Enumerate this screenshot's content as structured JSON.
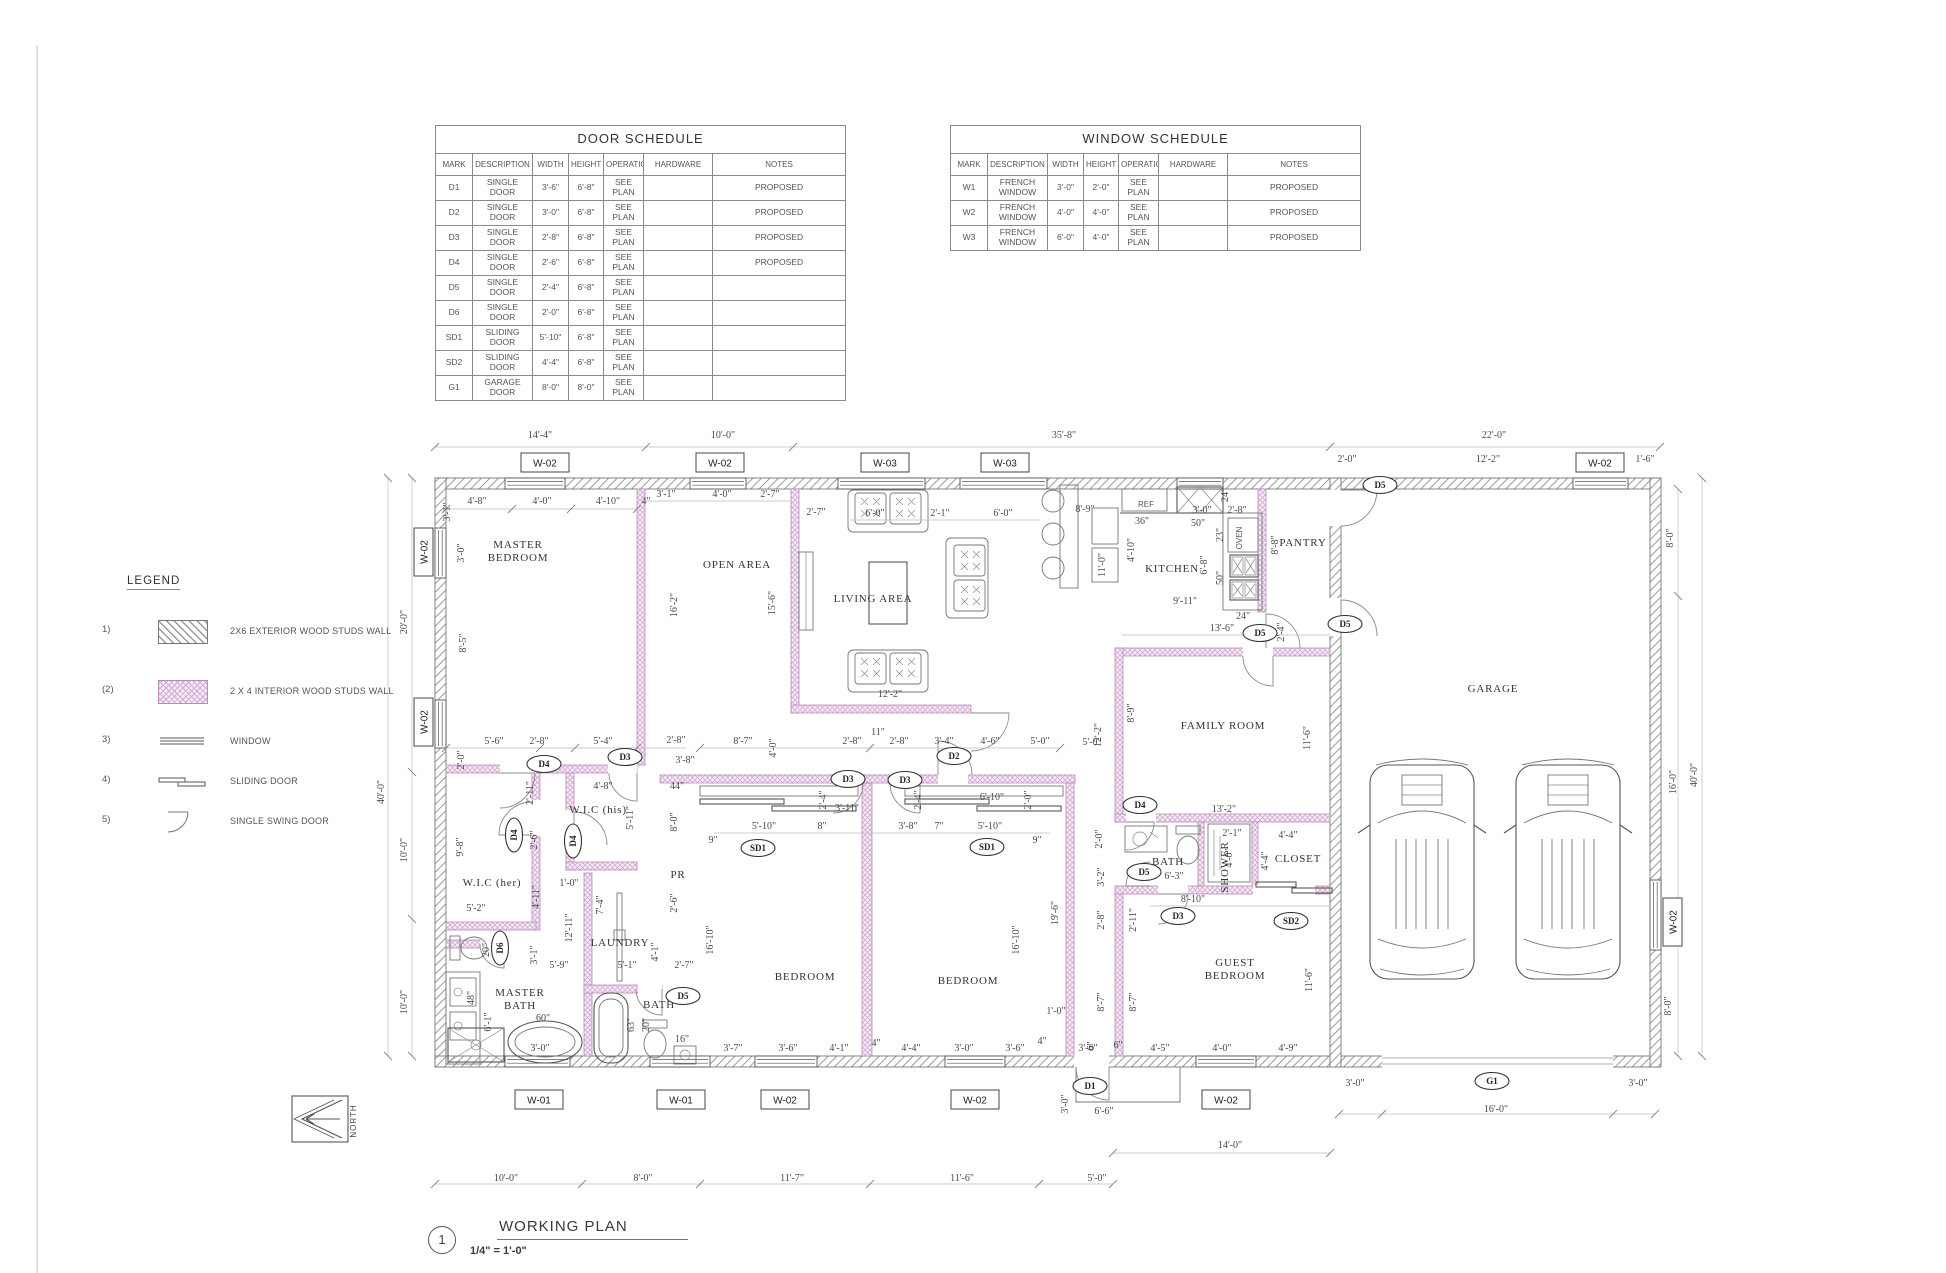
{
  "sheet": {
    "title_number": "1",
    "title": "WORKING PLAN",
    "scale": "1/4\" = 1'-0\"",
    "north_label": "NORTH"
  },
  "colors": {
    "interior_wall": "#d4a8d4",
    "exterior_wall_hatch": "#9a9a9a",
    "line": "#777777",
    "dim_text": "#4a4a4a"
  },
  "door_schedule": {
    "title": "DOOR SCHEDULE",
    "headers": [
      "MARK",
      "DESCRIPTION",
      "WIDTH",
      "HEIGHT",
      "OPERATION",
      "HARDWARE",
      "NOTES"
    ],
    "rows": [
      [
        "D1",
        "SINGLE DOOR",
        "3'-6\"",
        "6'-8\"",
        "SEE PLAN",
        "",
        "PROPOSED"
      ],
      [
        "D2",
        "SINGLE DOOR",
        "3'-0\"",
        "6'-8\"",
        "SEE PLAN",
        "",
        "PROPOSED"
      ],
      [
        "D3",
        "SINGLE DOOR",
        "2'-8\"",
        "6'-8\"",
        "SEE PLAN",
        "",
        "PROPOSED"
      ],
      [
        "D4",
        "SINGLE DOOR",
        "2'-6\"",
        "6'-8\"",
        "SEE PLAN",
        "",
        "PROPOSED"
      ],
      [
        "D5",
        "SINGLE DOOR",
        "2'-4\"",
        "6'-8\"",
        "SEE PLAN",
        "",
        ""
      ],
      [
        "D6",
        "SINGLE DOOR",
        "2'-0\"",
        "6'-8\"",
        "SEE PLAN",
        "",
        ""
      ],
      [
        "SD1",
        "SLIDING DOOR",
        "5'-10\"",
        "6'-8\"",
        "SEE PLAN",
        "",
        ""
      ],
      [
        "SD2",
        "SLIDING DOOR",
        "4'-4\"",
        "6'-8\"",
        "SEE PLAN",
        "",
        ""
      ],
      [
        "G1",
        "GARAGE DOOR",
        "8'-0\"",
        "8'-0\"",
        "SEE PLAN",
        "",
        ""
      ]
    ]
  },
  "window_schedule": {
    "title": "WINDOW SCHEDULE",
    "headers": [
      "MARK",
      "DESCRIPTION",
      "WIDTH",
      "HEIGHT",
      "OPERATION",
      "HARDWARE",
      "NOTES"
    ],
    "rows": [
      [
        "W1",
        "FRENCH WINDOW",
        "3'-0\"",
        "2'-0\"",
        "SEE PLAN",
        "",
        "PROPOSED"
      ],
      [
        "W2",
        "FRENCH WINDOW",
        "4'-0\"",
        "4'-0\"",
        "SEE PLAN",
        "",
        "PROPOSED"
      ],
      [
        "W3",
        "FRENCH WINDOW",
        "6'-0\"",
        "4'-0\"",
        "SEE PLAN",
        "",
        "PROPOSED"
      ]
    ]
  },
  "legend": {
    "title": "LEGEND",
    "items": [
      {
        "num": "1)",
        "label": "2X6 EXTERIOR WOOD STUDS  WALL",
        "symbol": "exterior-wall"
      },
      {
        "num": "(2)",
        "label": "2 X 4 INTERIOR WOOD STUDS WALL",
        "symbol": "interior-wall"
      },
      {
        "num": "3)",
        "label": "WINDOW",
        "symbol": "window"
      },
      {
        "num": "4)",
        "label": "SLIDING DOOR",
        "symbol": "sliding-door"
      },
      {
        "num": "5)",
        "label": "SINGLE SWING DOOR",
        "symbol": "single-swing-door"
      }
    ]
  },
  "plan": {
    "rooms": [
      {
        "lines": [
          "MASTER",
          "BEDROOM"
        ],
        "x": 518,
        "y": 548
      },
      {
        "lines": [
          "OPEN AREA"
        ],
        "x": 737,
        "y": 568
      },
      {
        "lines": [
          "LIVING AREA"
        ],
        "x": 873,
        "y": 602
      },
      {
        "lines": [
          "KITCHEN"
        ],
        "x": 1172,
        "y": 572
      },
      {
        "lines": [
          "PANTRY"
        ],
        "x": 1303,
        "y": 546
      },
      {
        "lines": [
          "FAMILY ROOM"
        ],
        "x": 1223,
        "y": 729
      },
      {
        "lines": [
          "GARAGE"
        ],
        "x": 1493,
        "y": 692
      },
      {
        "lines": [
          "W.I.C (his)"
        ],
        "x": 598,
        "y": 813
      },
      {
        "lines": [
          "W.I.C (her)"
        ],
        "x": 492,
        "y": 886
      },
      {
        "lines": [
          "LAUNDRY"
        ],
        "x": 620,
        "y": 946
      },
      {
        "lines": [
          "MASTER",
          "BATH"
        ],
        "x": 520,
        "y": 996
      },
      {
        "lines": [
          "BATH"
        ],
        "x": 659,
        "y": 1008
      },
      {
        "lines": [
          "PR"
        ],
        "x": 678,
        "y": 878
      },
      {
        "lines": [
          "BEDROOM"
        ],
        "x": 805,
        "y": 980
      },
      {
        "lines": [
          "BEDROOM"
        ],
        "x": 968,
        "y": 984
      },
      {
        "lines": [
          "GUEST",
          "BEDROOM"
        ],
        "x": 1235,
        "y": 966
      },
      {
        "lines": [
          "BATH"
        ],
        "x": 1168,
        "y": 865
      },
      {
        "lines": [
          "SHOWER"
        ],
        "x": 1228,
        "y": 867,
        "r": 1
      },
      {
        "lines": [
          "CLOSET"
        ],
        "x": 1298,
        "y": 862
      }
    ],
    "fixture_labels": [
      {
        "t": "REF",
        "x": 1146,
        "y": 507
      },
      {
        "t": "OVEN",
        "x": 1242,
        "y": 538,
        "r": 1
      }
    ],
    "window_tags": [
      {
        "t": "W-02",
        "x": 545,
        "y": 463
      },
      {
        "t": "W-02",
        "x": 720,
        "y": 463
      },
      {
        "t": "W-03",
        "x": 885,
        "y": 463
      },
      {
        "t": "W-03",
        "x": 1005,
        "y": 463
      },
      {
        "t": "W-02",
        "x": 1600,
        "y": 463
      },
      {
        "t": "W-02",
        "x": 424,
        "y": 552,
        "r": 1
      },
      {
        "t": "W-02",
        "x": 424,
        "y": 722,
        "r": 1
      },
      {
        "t": "W-02",
        "x": 1673,
        "y": 922,
        "r": 1
      },
      {
        "t": "W-01",
        "x": 539,
        "y": 1100
      },
      {
        "t": "W-01",
        "x": 681,
        "y": 1100
      },
      {
        "t": "W-02",
        "x": 785,
        "y": 1100
      },
      {
        "t": "W-02",
        "x": 975,
        "y": 1100
      },
      {
        "t": "W-02",
        "x": 1226,
        "y": 1100
      }
    ],
    "door_tags": [
      {
        "t": "D4",
        "x": 544,
        "y": 764
      },
      {
        "t": "D3",
        "x": 625,
        "y": 757
      },
      {
        "t": "D4",
        "x": 514,
        "y": 835,
        "r": 1
      },
      {
        "t": "D4",
        "x": 573,
        "y": 841,
        "r": 1
      },
      {
        "t": "D6",
        "x": 500,
        "y": 948,
        "r": 1
      },
      {
        "t": "D5",
        "x": 683,
        "y": 996
      },
      {
        "t": "D3",
        "x": 848,
        "y": 779
      },
      {
        "t": "D3",
        "x": 905,
        "y": 780
      },
      {
        "t": "D2",
        "x": 954,
        "y": 756
      },
      {
        "t": "SD1",
        "x": 758,
        "y": 848
      },
      {
        "t": "SD1",
        "x": 987,
        "y": 847
      },
      {
        "t": "D1",
        "x": 1090,
        "y": 1086
      },
      {
        "t": "D5",
        "x": 1144,
        "y": 872
      },
      {
        "t": "D3",
        "x": 1178,
        "y": 916
      },
      {
        "t": "SD2",
        "x": 1291,
        "y": 921
      },
      {
        "t": "D4",
        "x": 1140,
        "y": 805
      },
      {
        "t": "D5",
        "x": 1260,
        "y": 633
      },
      {
        "t": "D5",
        "x": 1345,
        "y": 624
      },
      {
        "t": "D5",
        "x": 1380,
        "y": 485
      },
      {
        "t": "G1",
        "x": 1492,
        "y": 1081
      }
    ],
    "dims": [
      [
        "14'-4\"",
        540,
        438
      ],
      [
        "10'-0\"",
        723,
        438
      ],
      [
        "35'-8\"",
        1064,
        438
      ],
      [
        "22'-0\"",
        1494,
        438
      ],
      [
        "2'-0\"",
        1347,
        462
      ],
      [
        "12'-2\"",
        1488,
        462
      ],
      [
        "1'-6\"",
        1645,
        462
      ],
      [
        "20'-0\"",
        407,
        622,
        1
      ],
      [
        "40'-0\"",
        384,
        792,
        1
      ],
      [
        "10'-0\"",
        407,
        850,
        1
      ],
      [
        "10'-0\"",
        407,
        1002,
        1
      ],
      [
        "8'-0\"",
        1673,
        538,
        1
      ],
      [
        "16'-0\"",
        1676,
        782,
        1
      ],
      [
        "8'-0\"",
        1671,
        1006,
        1
      ],
      [
        "40'-0\"",
        1697,
        775,
        1
      ],
      [
        "10'-0\"",
        506,
        1181
      ],
      [
        "8'-0\"",
        643,
        1181
      ],
      [
        "11'-7\"",
        792,
        1181
      ],
      [
        "11'-6\"",
        962,
        1181
      ],
      [
        "5'-0\"",
        1097,
        1181
      ],
      [
        "14'-0\"",
        1230,
        1148
      ],
      [
        "3'-0\"",
        1355,
        1086
      ],
      [
        "16'-0\"",
        1496,
        1112
      ],
      [
        "3'-0\"",
        1638,
        1086
      ],
      [
        "6'-6\"",
        1104,
        1114
      ],
      [
        "3'-0\"",
        1068,
        1104,
        1
      ],
      [
        "4'-8\"",
        477,
        504
      ],
      [
        "4'-0\"",
        542,
        504
      ],
      [
        "4'-10\"",
        608,
        504
      ],
      [
        "4\"",
        646,
        504
      ],
      [
        "3'-1\"",
        450,
        512,
        1
      ],
      [
        "3'-0\"",
        464,
        553,
        1
      ],
      [
        "8'-5\"",
        466,
        643,
        1
      ],
      [
        "3'-1\"",
        666,
        497
      ],
      [
        "4'-0\"",
        722,
        497
      ],
      [
        "2'-7\"",
        770,
        497
      ],
      [
        "16'-2\"",
        677,
        605,
        1
      ],
      [
        "2'-7\"",
        816,
        515
      ],
      [
        "15'-6\"",
        775,
        603,
        1
      ],
      [
        "6'-0\"",
        875,
        516
      ],
      [
        "2'-1\"",
        940,
        516
      ],
      [
        "6'-0\"",
        1003,
        516
      ],
      [
        "12'-2\"",
        890,
        697
      ],
      [
        "8'-9\"",
        1085,
        512
      ],
      [
        "11'-0\"",
        1105,
        565,
        1
      ],
      [
        "4'-10\"",
        1134,
        550,
        1
      ],
      [
        "36\"",
        1142,
        524
      ],
      [
        "50\"",
        1198,
        526
      ],
      [
        "3'-0\"",
        1202,
        513
      ],
      [
        "2'-8\"",
        1237,
        513
      ],
      [
        "24\"",
        1228,
        495,
        1
      ],
      [
        "23\"",
        1223,
        535,
        1
      ],
      [
        "50\"",
        1223,
        578,
        1
      ],
      [
        "6'-8\"",
        1207,
        565,
        1
      ],
      [
        "8'-8\"",
        1278,
        545,
        1
      ],
      [
        "9'-11\"",
        1185,
        604
      ],
      [
        "24\"",
        1243,
        619
      ],
      [
        "13'-6\"",
        1222,
        631
      ],
      [
        "2'-4\"",
        1284,
        632,
        1
      ],
      [
        "8'-9\"",
        1134,
        713,
        1
      ],
      [
        "12'-2\"",
        1101,
        735,
        1
      ],
      [
        "11'-6\"",
        1310,
        738,
        1
      ],
      [
        "13'-2\"",
        1224,
        812
      ],
      [
        "2'-0\"",
        1102,
        839,
        1
      ],
      [
        "5'-0\"",
        1092,
        745
      ],
      [
        "2'-1\"",
        1232,
        836
      ],
      [
        "4'-4\"",
        1288,
        838
      ],
      [
        "4'-0\"",
        1232,
        858,
        1
      ],
      [
        "4'-4\"",
        1268,
        861,
        1
      ],
      [
        "6'-3\"",
        1174,
        879
      ],
      [
        "8'-10\"",
        1193,
        902
      ],
      [
        "2'-11\"",
        1136,
        920,
        1
      ],
      [
        "3'-2\"",
        1104,
        877,
        1
      ],
      [
        "2'-8\"",
        1104,
        920,
        1
      ],
      [
        "8'-7\"",
        1104,
        1002,
        1
      ],
      [
        "8'-7\"",
        1136,
        1002,
        1
      ],
      [
        "11'-6\"",
        1312,
        980,
        1
      ],
      [
        "6\"",
        1118,
        1048
      ],
      [
        "4'-5\"",
        1160,
        1051
      ],
      [
        "4'-0\"",
        1222,
        1051
      ],
      [
        "4'-9\"",
        1288,
        1051
      ],
      [
        "5'-6\"",
        494,
        744
      ],
      [
        "2'-8\"",
        539,
        744
      ],
      [
        "5'-4\"",
        603,
        744
      ],
      [
        "2'-8\"",
        676,
        743
      ],
      [
        "3'-8\"",
        685,
        763
      ],
      [
        "2'-0\"",
        464,
        760,
        1
      ],
      [
        "2'-11\"",
        533,
        793,
        1
      ],
      [
        "4'-8\"",
        603,
        789
      ],
      [
        "44\"",
        677,
        789
      ],
      [
        "5'-11\"",
        633,
        818,
        1
      ],
      [
        "8'-0\"",
        677,
        822,
        1
      ],
      [
        "9'-8\"",
        463,
        847,
        1
      ],
      [
        "2'-6\"",
        537,
        840,
        1
      ],
      [
        "4'-11\"",
        539,
        897,
        1
      ],
      [
        "1'-0\"",
        569,
        886
      ],
      [
        "12'-11\"",
        572,
        928,
        1
      ],
      [
        "7'-4\"",
        603,
        905,
        1
      ],
      [
        "2'-6\"",
        677,
        903,
        1
      ],
      [
        "5'-2\"",
        476,
        911
      ],
      [
        "3'-1\"",
        537,
        955,
        1
      ],
      [
        "5'-9\"",
        559,
        968
      ],
      [
        "5'-1\"",
        627,
        968
      ],
      [
        "4'-1\"",
        658,
        952,
        1
      ],
      [
        "2'-7\"",
        684,
        968
      ],
      [
        "6'-1\"",
        491,
        1022,
        1
      ],
      [
        "60\"",
        543,
        1021
      ],
      [
        "48\"",
        474,
        998,
        1
      ],
      [
        "3'-0\"",
        540,
        1051
      ],
      [
        "20\"",
        489,
        950,
        1
      ],
      [
        "20\"",
        649,
        1025,
        1
      ],
      [
        "63\"",
        634,
        1025,
        1
      ],
      [
        "16\"",
        682,
        1042
      ],
      [
        "8'-7\"",
        743,
        744
      ],
      [
        "4'-0\"",
        776,
        748,
        1
      ],
      [
        "2'-8\"",
        852,
        744
      ],
      [
        "11\"",
        878,
        735
      ],
      [
        "2'-8\"",
        899,
        744
      ],
      [
        "3'-4\"",
        944,
        744
      ],
      [
        "4'-6\"",
        990,
        744
      ],
      [
        "5'-0\"",
        1040,
        744
      ],
      [
        "2'-4\"",
        826,
        800,
        1
      ],
      [
        "3'-11\"",
        847,
        811
      ],
      [
        "2'-4\"",
        921,
        800,
        1
      ],
      [
        "6'-10\"",
        992,
        800
      ],
      [
        "2'-0\"",
        1031,
        800,
        1
      ],
      [
        "5'-10\"",
        764,
        829
      ],
      [
        "8\"",
        822,
        829
      ],
      [
        "3'-8\"",
        908,
        829
      ],
      [
        "7\"",
        939,
        829
      ],
      [
        "5'-10\"",
        990,
        829
      ],
      [
        "9\"",
        713,
        843
      ],
      [
        "9\"",
        1037,
        843
      ],
      [
        "16'-10\"",
        713,
        940,
        1
      ],
      [
        "16'-10\"",
        1019,
        940,
        1
      ],
      [
        "19'-6\"",
        1058,
        913,
        1
      ],
      [
        "1'-0\"",
        1056,
        1014
      ],
      [
        "3'-7\"",
        733,
        1051
      ],
      [
        "3'-6\"",
        788,
        1051
      ],
      [
        "4'-1\"",
        839,
        1051
      ],
      [
        "4\"",
        876,
        1046
      ],
      [
        "4'-4\"",
        911,
        1051
      ],
      [
        "3'-0\"",
        964,
        1051
      ],
      [
        "3'-6\"",
        1015,
        1051
      ],
      [
        "4\"",
        1042,
        1044
      ],
      [
        "3'-6\"",
        1088,
        1051
      ],
      [
        "6\"",
        1094,
        1046,
        1
      ]
    ]
  }
}
